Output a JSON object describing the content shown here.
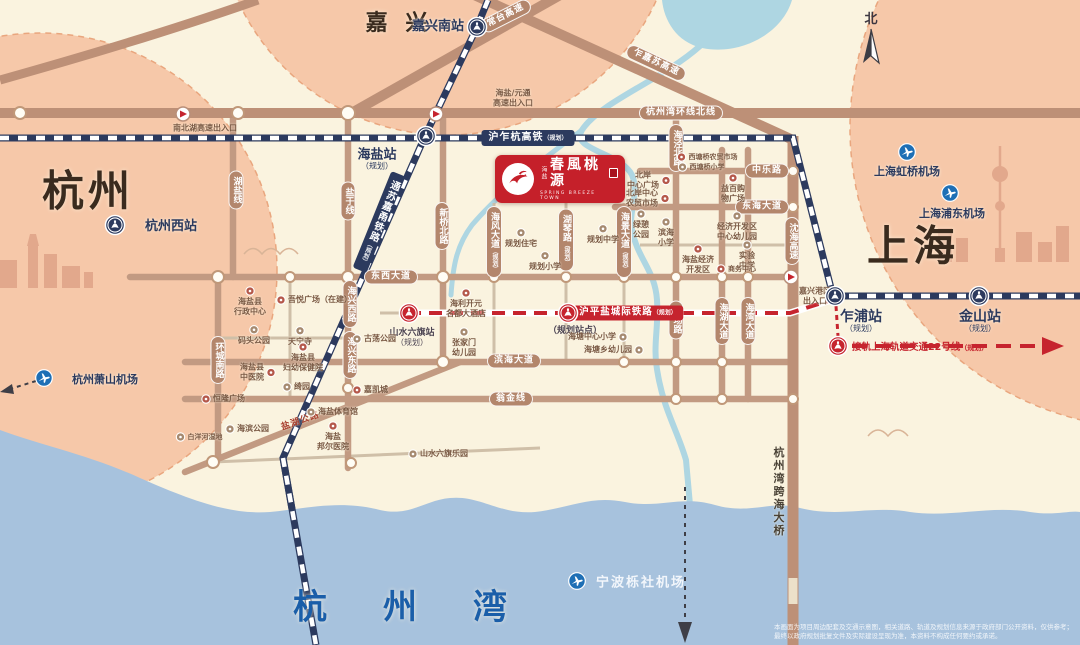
{
  "project": {
    "prefix": "海盐",
    "name": "春風桃源",
    "subtitle": "SPRING BREEZE TOWN"
  },
  "compass": {
    "label": "北"
  },
  "sea": {
    "name": "杭州湾"
  },
  "big_labels": [
    {
      "t": "杭州",
      "x": 88,
      "y": 188,
      "fs": 42,
      "c": "#3a2b1e",
      "ls": 4
    },
    {
      "t": "上海",
      "x": 913,
      "y": 243,
      "fs": 42,
      "c": "#3a2b1e",
      "ls": 4
    },
    {
      "t": "嘉 兴",
      "x": 399,
      "y": 21,
      "fs": 22,
      "c": "#3a2b1e",
      "ls": 5
    },
    {
      "t": "杭州湾",
      "x": 428,
      "y": 604,
      "fs": 34,
      "c": "#1a5ea9",
      "ls": 56
    }
  ],
  "road_labels": [
    {
      "t": "杭州湾环线北线",
      "x": 681,
      "y": 113
    },
    {
      "t": "东西大道",
      "x": 391,
      "y": 277
    },
    {
      "t": "滨海大道",
      "x": 514,
      "y": 361
    },
    {
      "t": "翁金线",
      "x": 511,
      "y": 399
    },
    {
      "t": "中乐路",
      "x": 767,
      "y": 171
    },
    {
      "t": "东海大道",
      "x": 762,
      "y": 207
    },
    {
      "t": "湖盐线",
      "x": 236,
      "y": 190,
      "v": 1
    },
    {
      "t": "盐于线",
      "x": 348,
      "y": 201,
      "v": 1
    },
    {
      "t": "新桥北路",
      "x": 442,
      "y": 226,
      "v": 1
    },
    {
      "t": "海风大道",
      "s": "（规划）",
      "x": 494,
      "y": 242,
      "v": 1
    },
    {
      "t": "湖琴路",
      "s": "（规划）",
      "x": 566,
      "y": 240,
      "v": 1
    },
    {
      "t": "海景大道",
      "s": "（规划）",
      "x": 624,
      "y": 242,
      "v": 1
    },
    {
      "t": "海泾北路",
      "x": 676,
      "y": 148,
      "v": 1
    },
    {
      "t": "西场路",
      "x": 676,
      "y": 320,
      "v": 1
    },
    {
      "t": "海湖大道",
      "x": 722,
      "y": 321,
      "v": 1
    },
    {
      "t": "海湾大道",
      "x": 748,
      "y": 321,
      "v": 1
    },
    {
      "t": "环城南路",
      "x": 218,
      "y": 360,
      "v": 1
    },
    {
      "t": "海兴西路",
      "x": 350,
      "y": 304,
      "v": 1
    },
    {
      "t": "海兴东路",
      "x": 350,
      "y": 355,
      "v": 1
    },
    {
      "t": "常台高速",
      "x": 506,
      "y": 16,
      "r": -27
    },
    {
      "t": "乍嘉苏高速",
      "x": 656,
      "y": 63,
      "r": 25
    },
    {
      "t": "沈海高速",
      "x": 792,
      "y": 241,
      "v": 1
    },
    {
      "t": "盐湖公路",
      "x": 300,
      "y": 420,
      "r": -19,
      "plain": 1,
      "color": "#a8402f"
    },
    {
      "t": "杭州湾跨海大桥",
      "x": 778,
      "y": 492,
      "v": 1,
      "plain": 1,
      "color": "#4a4236"
    }
  ],
  "rail_labels": [
    {
      "t": "沪乍杭高铁",
      "s": "（规划）",
      "x": 528,
      "y": 138,
      "theme": "navy"
    },
    {
      "t": "通苏嘉甬铁路",
      "s": "（规划）",
      "x": 379,
      "y": 222,
      "theme": "navy",
      "v": 1,
      "r": 22
    },
    {
      "t": "沪平盐城际铁路",
      "s": "（规划）",
      "x": 628,
      "y": 313,
      "theme": "red"
    }
  ],
  "metro22": {
    "text": "接轨上海轨道交通22号线",
    "sub": "（规划）",
    "icon_x": 838,
    "icon_y": 346,
    "lx": 852,
    "ly": 346
  },
  "stations": [
    {
      "n": "嘉兴南站",
      "ix": 477,
      "iy": 27,
      "lx": 438,
      "ly": 27,
      "theme": "navy",
      "fs": 13
    },
    {
      "n": "海盐站",
      "s": "（规划）",
      "ix": 426,
      "iy": 136,
      "lx": 377,
      "ly": 160,
      "theme": "navy",
      "fs": 13
    },
    {
      "n": "杭州西站",
      "ix": 115,
      "iy": 225,
      "lx": 171,
      "ly": 227,
      "theme": "navy",
      "fs": 13
    },
    {
      "n": "乍浦站",
      "s": "（规划）",
      "ix": 835,
      "iy": 296,
      "lx": 861,
      "ly": 322,
      "theme": "navy",
      "fs": 14
    },
    {
      "n": "金山站",
      "s": "（规划）",
      "ix": 979,
      "iy": 296,
      "lx": 980,
      "ly": 322,
      "theme": "navy",
      "fs": 14
    },
    {
      "n": "山水六旗站",
      "s": "（规划）",
      "ix": 409,
      "iy": 313,
      "lx": 412,
      "ly": 338,
      "theme": "red",
      "fs": 9
    },
    {
      "n": "（规划站点）",
      "ix": 568,
      "iy": 313,
      "lx": 575,
      "ly": 332,
      "theme": "red",
      "fs": 9
    }
  ],
  "airports": [
    {
      "n": "杭州萧山机场",
      "ix": 44,
      "iy": 378,
      "lx": 105,
      "ly": 379,
      "white": 0
    },
    {
      "n": "上海虹桥机场",
      "ix": 907,
      "iy": 152,
      "lx": 907,
      "ly": 171,
      "white": 0
    },
    {
      "n": "上海浦东机场",
      "ix": 950,
      "iy": 193,
      "lx": 952,
      "ly": 213,
      "white": 0
    },
    {
      "n": "宁波栎社机场",
      "ix": 577,
      "iy": 581,
      "lx": 641,
      "ly": 581,
      "white": 1
    }
  ],
  "interchanges": [
    {
      "t": "南北湖高速出入口",
      "ix": 183,
      "iy": 114,
      "lx": 205,
      "ly": 128
    },
    {
      "t": "海盐/元通\n高速出入口",
      "ix": 436,
      "iy": 114,
      "lx": 513,
      "ly": 98
    },
    {
      "t": "嘉兴港区\n出入口",
      "ix": 791,
      "iy": 277,
      "lx": 815,
      "ly": 296
    }
  ],
  "pois": [
    {
      "t": "海盐县\n行政中心",
      "x": 250,
      "y": 301,
      "side": "top",
      "c": "red"
    },
    {
      "t": "吾悦广场（在建）",
      "x": 314,
      "y": 300,
      "side": "left",
      "c": "red"
    },
    {
      "t": "码头公园",
      "x": 254,
      "y": 335,
      "side": "top",
      "c": "tan"
    },
    {
      "t": "天宁寺",
      "x": 300,
      "y": 336,
      "side": "top",
      "c": "tan"
    },
    {
      "t": "海盐县\n妇幼保健院",
      "x": 303,
      "y": 357,
      "side": "top",
      "c": "red"
    },
    {
      "t": "海盐县\n中医院",
      "x": 258,
      "y": 372,
      "side": "right",
      "c": "red"
    },
    {
      "t": "绮园",
      "x": 296,
      "y": 387,
      "side": "left",
      "c": "tan"
    },
    {
      "t": "恒隆广场",
      "x": 223,
      "y": 399,
      "side": "left",
      "c": "red"
    },
    {
      "t": "嘉凯城",
      "x": 370,
      "y": 390,
      "side": "left",
      "c": "red"
    },
    {
      "t": "海盐体育馆",
      "x": 332,
      "y": 412,
      "side": "left",
      "c": "tan"
    },
    {
      "t": "海滨公园",
      "x": 247,
      "y": 429,
      "side": "left",
      "c": "tan"
    },
    {
      "t": "海盐\n邦尔医院",
      "x": 333,
      "y": 436,
      "side": "top",
      "c": "red"
    },
    {
      "t": "白洋河湿地",
      "x": 199,
      "y": 437,
      "side": "left",
      "c": "tan",
      "tiny": 1
    },
    {
      "t": "山水六旗乐园",
      "x": 438,
      "y": 454,
      "side": "left",
      "c": "tan"
    },
    {
      "t": "古荡公园",
      "x": 374,
      "y": 339,
      "side": "left",
      "c": "tan"
    },
    {
      "t": "张家门\n幼儿园",
      "x": 464,
      "y": 342,
      "side": "top",
      "c": "tan"
    },
    {
      "t": "海利开元\n名都大酒店",
      "x": 466,
      "y": 303,
      "side": "top",
      "c": "red"
    },
    {
      "t": "规划住宅",
      "x": 521,
      "y": 238,
      "side": "top",
      "c": "tan"
    },
    {
      "t": "规划中学",
      "x": 603,
      "y": 234,
      "side": "top",
      "c": "tan"
    },
    {
      "t": "规划小学",
      "x": 545,
      "y": 261,
      "side": "top",
      "c": "tan"
    },
    {
      "t": "北岸\n中心广场",
      "x": 649,
      "y": 180,
      "side": "right",
      "c": "red"
    },
    {
      "t": "北岸中心\n农贸市场",
      "x": 648,
      "y": 198,
      "side": "right",
      "c": "red"
    },
    {
      "t": "西塘桥农贸市场",
      "x": 707,
      "y": 157,
      "side": "left",
      "c": "red",
      "tiny": 1
    },
    {
      "t": "西塘桥小学",
      "x": 701,
      "y": 167,
      "side": "left",
      "c": "tan",
      "tiny": 1
    },
    {
      "t": "益百购\n物广场",
      "x": 733,
      "y": 188,
      "side": "top",
      "c": "red"
    },
    {
      "t": "绿憩\n公园",
      "x": 641,
      "y": 224,
      "side": "top",
      "c": "tan"
    },
    {
      "t": "滨海\n小学",
      "x": 666,
      "y": 232,
      "side": "top",
      "c": "tan"
    },
    {
      "t": "经济开发区\n中心幼儿园",
      "x": 737,
      "y": 226,
      "side": "top",
      "c": "tan"
    },
    {
      "t": "实验\n中学",
      "x": 747,
      "y": 255,
      "side": "top",
      "c": "tan"
    },
    {
      "t": "商务中心",
      "x": 736,
      "y": 269,
      "side": "left",
      "c": "red",
      "tiny": 1
    },
    {
      "t": "海盐经济\n开发区",
      "x": 698,
      "y": 259,
      "side": "top",
      "c": "red"
    },
    {
      "t": "海塘中心小学",
      "x": 598,
      "y": 337,
      "side": "right",
      "c": "tan"
    },
    {
      "t": "海塘乡幼儿园",
      "x": 614,
      "y": 350,
      "side": "right",
      "c": "tan"
    }
  ],
  "disclaimer": {
    "line1": "本画面为项目周边配套及交通示意图，相关道路、轨道及规划信息来源于政府部门公开资料，仅供参考；",
    "line2": "最终以政府规划批复文件及实际建设呈现为准，本资料不构成任何要约或承诺。"
  },
  "colors": {
    "accent_red": "#c6242e",
    "rail_navy": "#2c3a5e",
    "road_brown": "#c29a82",
    "zone_pink": "#f6c8a9",
    "sea_blue": "#a7c2dd",
    "bg_cream": "#faf3df"
  }
}
